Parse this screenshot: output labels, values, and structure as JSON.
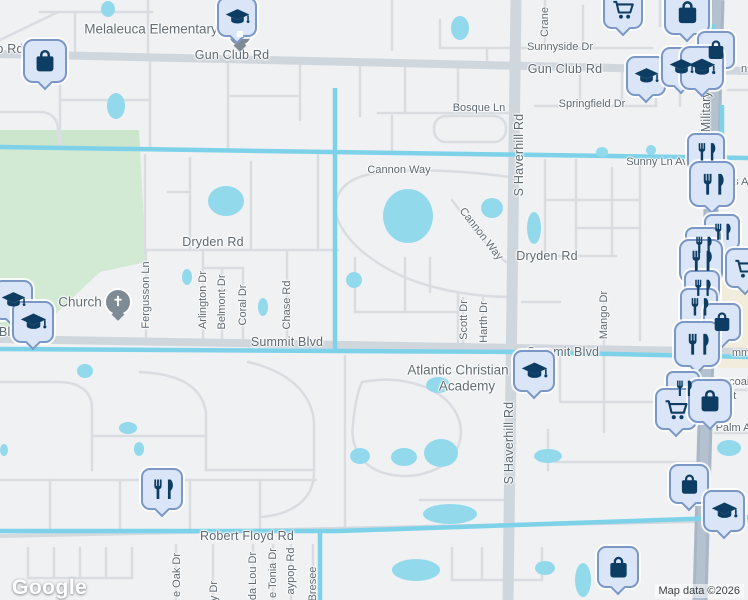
{
  "map": {
    "logo_label": "Google",
    "attribution": "Map data ©2026",
    "colors": {
      "land": "#eff1f3",
      "park": "#d2e9d3",
      "water": "#7dd2e9",
      "pond": "#92d9ec",
      "road_minor": "#d9dde1",
      "road_major": "#cfd6dc",
      "highway": "#a8b6c5",
      "commercial": "#f2ecdc",
      "pin_fill": "#dae5f7",
      "pin_border": "#7b97c6",
      "pin_glyph": "#0d3d63",
      "label_text": "#5d6870"
    },
    "labels": [
      {
        "text": "Melaleuca Elementary",
        "x": 151,
        "y": 29,
        "rot": 0,
        "cls": "p"
      },
      {
        "text": "b Rd",
        "x": 10,
        "y": 49,
        "rot": 0,
        "cls": "R"
      },
      {
        "text": "Gun Club Rd",
        "x": 232,
        "y": 55,
        "rot": 0,
        "cls": "R"
      },
      {
        "text": "Gun Club Rd",
        "x": 565,
        "y": 69,
        "rot": 0,
        "cls": "R"
      },
      {
        "text": "Sunnyside Dr",
        "x": 560,
        "y": 47,
        "rot": 0,
        "cls": "r"
      },
      {
        "text": "Crane",
        "x": 545,
        "y": 22,
        "rot": -90,
        "cls": "r"
      },
      {
        "text": "Springfield Dr",
        "x": 592,
        "y": 104,
        "rot": 0,
        "cls": "r"
      },
      {
        "text": "Bosque Ln",
        "x": 479,
        "y": 108,
        "rot": 0,
        "cls": "r"
      },
      {
        "text": "Sunny Ln Av",
        "x": 657,
        "y": 162,
        "rot": 0,
        "cls": "r"
      },
      {
        "text": "Military Tr",
        "x": 706,
        "y": 104,
        "rot": -90,
        "cls": "R"
      },
      {
        "text": "rs A",
        "x": 739,
        "y": 182,
        "rot": 0,
        "cls": "f"
      },
      {
        "text": "n",
        "x": 744,
        "y": 69,
        "rot": 0,
        "cls": "f"
      },
      {
        "text": "Cannon Way",
        "x": 399,
        "y": 170,
        "rot": 0,
        "cls": "r"
      },
      {
        "text": "Cannon Way",
        "x": 481,
        "y": 234,
        "rot": 52,
        "cls": "r"
      },
      {
        "text": "Dryden Rd",
        "x": 213,
        "y": 242,
        "rot": 0,
        "cls": "R"
      },
      {
        "text": "Dryden Rd",
        "x": 547,
        "y": 256,
        "rot": 0,
        "cls": "R"
      },
      {
        "text": "S Haverhill Rd",
        "x": 519,
        "y": 155,
        "rot": -90,
        "cls": "R"
      },
      {
        "text": "S Haverhill Rd",
        "x": 509,
        "y": 443,
        "rot": -90,
        "cls": "R"
      },
      {
        "text": "Fergusson Ln",
        "x": 146,
        "y": 295,
        "rot": -90,
        "cls": "r"
      },
      {
        "text": "Arlington Dr",
        "x": 203,
        "y": 300,
        "rot": -90,
        "cls": "r"
      },
      {
        "text": "Belmont Dr",
        "x": 222,
        "y": 302,
        "rot": -90,
        "cls": "r"
      },
      {
        "text": "Coral Dr",
        "x": 243,
        "y": 305,
        "rot": -90,
        "cls": "r"
      },
      {
        "text": "Chase Rd",
        "x": 287,
        "y": 305,
        "rot": -90,
        "cls": "r"
      },
      {
        "text": "Church",
        "x": 80,
        "y": 302,
        "rot": 0,
        "cls": "p"
      },
      {
        "text": "Blv",
        "x": 8,
        "y": 332,
        "rot": 0,
        "cls": "R"
      },
      {
        "text": "Summit Blvd",
        "x": 287,
        "y": 342,
        "rot": 0,
        "cls": "R"
      },
      {
        "text": "Summit Blvd",
        "x": 563,
        "y": 352,
        "rot": 0,
        "cls": "R"
      },
      {
        "text": "Scott Dr",
        "x": 464,
        "y": 320,
        "rot": -90,
        "cls": "r"
      },
      {
        "text": "Harth Dr",
        "x": 484,
        "y": 322,
        "rot": -90,
        "cls": "r"
      },
      {
        "text": "Mango Dr",
        "x": 604,
        "y": 315,
        "rot": -90,
        "cls": "r"
      },
      {
        "text": "Atlantic Christian",
        "x": 458,
        "y": 370,
        "rot": 0,
        "cls": "p"
      },
      {
        "text": "Academy",
        "x": 467,
        "y": 386,
        "rot": 0,
        "cls": "p"
      },
      {
        "text": "mm",
        "x": 741,
        "y": 353,
        "rot": 0,
        "cls": "f"
      },
      {
        "text": "Cocoan",
        "x": 734,
        "y": 382,
        "rot": 0,
        "cls": "f"
      },
      {
        "text": "est",
        "x": 729,
        "y": 396,
        "rot": 0,
        "cls": "f"
      },
      {
        "text": "Palm A",
        "x": 733,
        "y": 428,
        "rot": 0,
        "cls": "r"
      },
      {
        "text": "Robert Floyd Rd",
        "x": 247,
        "y": 536,
        "rot": 0,
        "cls": "R"
      },
      {
        "text": "e Oak Dr",
        "x": 177,
        "y": 575,
        "rot": -90,
        "cls": "r"
      },
      {
        "text": "y Dr",
        "x": 214,
        "y": 591,
        "rot": -90,
        "cls": "r"
      },
      {
        "text": "da Lou Dr",
        "x": 253,
        "y": 576,
        "rot": -90,
        "cls": "r"
      },
      {
        "text": "e Tonia Dr",
        "x": 273,
        "y": 573,
        "rot": -90,
        "cls": "r"
      },
      {
        "text": "aypop Rd",
        "x": 291,
        "y": 571,
        "rot": -90,
        "cls": "r"
      },
      {
        "text": "Bresee",
        "x": 313,
        "y": 584,
        "rot": -90,
        "cls": "r"
      }
    ],
    "pins": [
      {
        "type": "school-poi",
        "x": 240,
        "y": 34,
        "s": 22
      },
      {
        "type": "graduation-cap",
        "x": 237,
        "y": 17,
        "s": 40
      },
      {
        "type": "shopping-bag",
        "x": 45,
        "y": 61,
        "s": 44
      },
      {
        "type": "shopping-cart",
        "x": 623,
        "y": 9,
        "s": 40
      },
      {
        "type": "shopping-bag",
        "x": 687,
        "y": 12,
        "s": 46
      },
      {
        "type": "shopping-bag",
        "x": 716,
        "y": 50,
        "s": 38
      },
      {
        "type": "graduation-cap",
        "x": 646,
        "y": 76,
        "s": 40
      },
      {
        "type": "graduation-cap",
        "x": 681,
        "y": 67,
        "s": 40
      },
      {
        "type": "graduation-cap",
        "x": 702,
        "y": 68,
        "s": 44
      },
      {
        "type": "restaurant",
        "x": 706,
        "y": 152,
        "s": 38
      },
      {
        "type": "restaurant",
        "x": 712,
        "y": 184,
        "s": 46
      },
      {
        "type": "restaurant",
        "x": 722,
        "y": 232,
        "s": 36
      },
      {
        "type": "restaurant",
        "x": 703,
        "y": 245,
        "s": 36
      },
      {
        "type": "restaurant",
        "x": 701,
        "y": 261,
        "s": 44
      },
      {
        "type": "shopping-cart",
        "x": 745,
        "y": 268,
        "s": 40
      },
      {
        "type": "restaurant",
        "x": 702,
        "y": 288,
        "s": 36
      },
      {
        "type": "restaurant",
        "x": 699,
        "y": 307,
        "s": 38
      },
      {
        "type": "shopping-bag",
        "x": 722,
        "y": 322,
        "s": 38
      },
      {
        "type": "restaurant",
        "x": 697,
        "y": 344,
        "s": 46
      },
      {
        "type": "church-poi",
        "x": 118,
        "y": 302,
        "s": 24
      },
      {
        "type": "graduation-cap",
        "x": 13,
        "y": 300,
        "s": 40
      },
      {
        "type": "graduation-cap",
        "x": 33,
        "y": 322,
        "s": 42
      },
      {
        "type": "graduation-cap",
        "x": 534,
        "y": 371,
        "s": 42
      },
      {
        "type": "restaurant",
        "x": 683,
        "y": 388,
        "s": 34
      },
      {
        "type": "shopping-cart",
        "x": 676,
        "y": 409,
        "s": 42
      },
      {
        "type": "shopping-bag",
        "x": 710,
        "y": 401,
        "s": 44
      },
      {
        "type": "restaurant",
        "x": 162,
        "y": 489,
        "s": 42
      },
      {
        "type": "shopping-bag",
        "x": 689,
        "y": 484,
        "s": 40
      },
      {
        "type": "graduation-cap",
        "x": 724,
        "y": 511,
        "s": 42
      },
      {
        "type": "shopping-bag",
        "x": 618,
        "y": 567,
        "s": 42
      }
    ]
  }
}
